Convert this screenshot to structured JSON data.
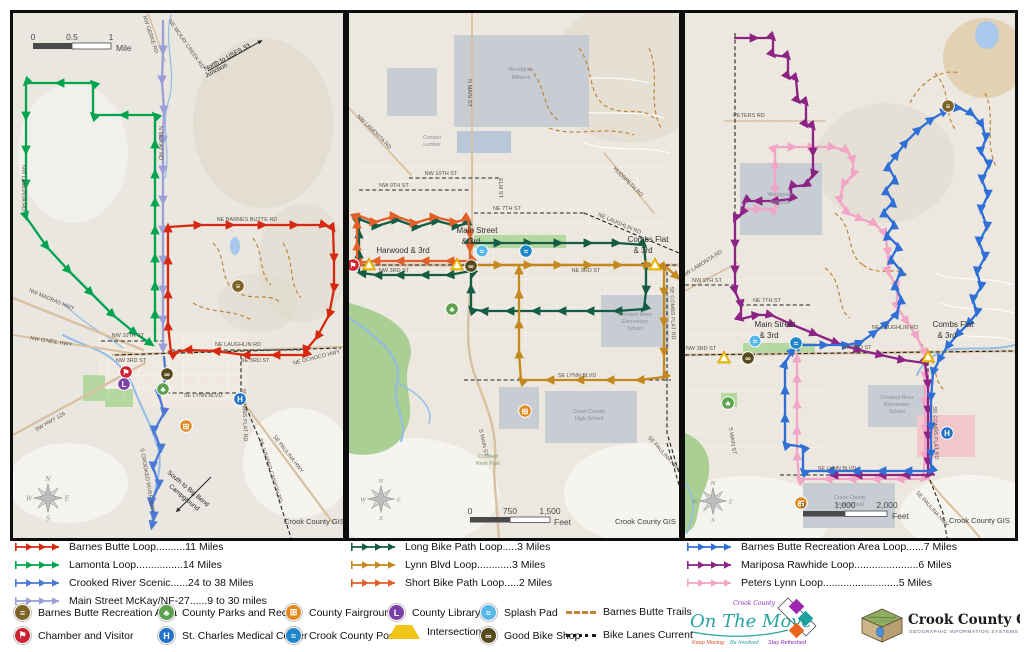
{
  "legend": {
    "left_routes": [
      {
        "label": "Barnes Butte Loop..........11 Miles",
        "color": "#d62910"
      },
      {
        "label": "Lamonta Loop................14 Miles",
        "color": "#00a44f"
      },
      {
        "label": "Crooked River Scenic......24 to 38 Miles",
        "color": "#4b79d4"
      },
      {
        "label": "Main Street McKay/NF-27......9 to 30 miles",
        "color": "#9c9ed8"
      }
    ],
    "mid_routes": [
      {
        "label": "Long Bike Path Loop.....3 Miles",
        "color": "#155c44"
      },
      {
        "label": "Lynn Blvd Loop............3 Miles",
        "color": "#c4881c"
      },
      {
        "label": "Short Bike Path Loop.....2 Miles",
        "color": "#e45f28"
      }
    ],
    "right_routes": [
      {
        "label": "Barnes Butte Recreation Area Loop......7 Miles",
        "color": "#2f6fd6"
      },
      {
        "label": "Mariposa Rawhide Loop......................6 Miles",
        "color": "#8c2385"
      },
      {
        "label": "Peters Lynn Loop..........................5 Miles",
        "color": "#f2a5c6"
      }
    ],
    "poi": {
      "butte": {
        "label": "Barnes Butte Recreation Area",
        "glyph": "≡",
        "color": "#7d6327"
      },
      "parks": {
        "label": "County Parks and Rec",
        "glyph": "♣",
        "color": "#5ba04b"
      },
      "fairgrounds": {
        "label": "County Fairgrounds",
        "glyph": "⊞",
        "color": "#e2891d"
      },
      "library": {
        "label": "County Library",
        "glyph": "L",
        "color": "#7b3fa8"
      },
      "splash": {
        "label": "Splash Pad",
        "glyph": "≈",
        "color": "#56b8e8"
      },
      "chamber": {
        "label": "Chamber and Visitor",
        "glyph": "⚑",
        "color": "#cf2030"
      },
      "hospital": {
        "label": "St. Charles Medical Center",
        "glyph": "H",
        "color": "#2272c8"
      },
      "pool": {
        "label": "Crook County Pool",
        "glyph": "≈",
        "color": "#1f86c9"
      },
      "intersections": {
        "label": "Intersections",
        "glyph": "",
        "color": "#f2c319"
      },
      "bikeshop": {
        "label": "Good Bike Shop",
        "glyph": "∞",
        "color": "#564a1a"
      }
    },
    "line_types": [
      {
        "label": "Barnes Butte Trails",
        "style": "dashed",
        "color": "#c08438"
      },
      {
        "label": "Bike Lanes Current",
        "style": "dotted",
        "color": "#1a1a1a"
      }
    ]
  },
  "compass": {
    "n": "N",
    "e": "E",
    "s": "S",
    "w": "W"
  },
  "maps": [
    {
      "scale": {
        "t0": "0",
        "t1": "0.5",
        "t2": "1",
        "unit": "Mile"
      },
      "attribution": "Crook County GIS",
      "annotations": {
        "north1": "North to USFS 33",
        "north2": "Junction",
        "south1": "South to Big Bend",
        "south2": "Campground"
      },
      "roads": {
        "gerke": "NW GERKE RD",
        "mckaycreek": "NE MCKAY CREEK RD",
        "mckay": "N MCKAY RD",
        "lamonta": "NW LAMONTA RD",
        "barnesbutte": "NE BARNES BUTTE RD",
        "madras": "NW MADRAS HWY",
        "oneil": "NW O'NEIL HWY",
        "hwy126": "SW HWY 126",
        "st10": "NW 10TH ST",
        "laughlin": "NE LAUGHLIN RD",
        "st3w": "NW 3RD ST",
        "st3e": "NE 3RD ST",
        "ochoco": "NE OCHOCO HWY",
        "lynn": "SE LYNN BLVD",
        "combs": "SE COMBS FLAT RD",
        "paulina": "SE PAULINA HWY",
        "juniper": "SE JUNIPER CANYON RD",
        "crookedriver": "S CROOKED RIVER HWY"
      }
    },
    {
      "scale": {
        "t0": "0",
        "t1": "750",
        "t2": "1,500",
        "unit": "Feet"
      },
      "attribution": "Crook County GIS",
      "junctions": {
        "harwood": "Harwood & 3rd",
        "main1": "Main Street",
        "main2": "& 3rd",
        "combs1": "Combs Flat",
        "combs2": "& 3rd"
      },
      "roads": {
        "lamonta": "NW LAMONTA RD",
        "main_n": "N MAIN ST",
        "st10": "NW 10TH ST",
        "st9": "NW 9TH ST",
        "st7": "NE 7TH ST",
        "laughlin": "NE LAUGHLIN RD",
        "hudspeth": "HUDSPETH RD",
        "elm": "ELM ST",
        "st3w": "NW 3RD ST",
        "st3e": "NE 3RD ST",
        "lynn": "SE LYNN BLVD",
        "main_s": "S MAIN ST",
        "combs": "SE COMBS FLAT RD",
        "paulina": "SE PAULINA HWY"
      },
      "places": {
        "wg1": "Woodgrain",
        "wg2": "Millwork",
        "cl1": "Contact",
        "cl2": "Lumber",
        "el1": "Crooked River",
        "el2": "Elementary",
        "el3": "School",
        "hs1": "Crook County",
        "hs2": "High School",
        "pk1": "Crooked",
        "pk2": "River Park"
      }
    },
    {
      "scale": {
        "t0": "0",
        "t1": "1,000",
        "t2": "2,000",
        "unit": "Feet"
      },
      "attribution": "Crook County GIS",
      "junctions": {
        "main1": "Main Street",
        "main2": "& 3rd",
        "combs1": "Combs Flat",
        "combs2": "& 3rd"
      },
      "roads": {
        "peters": "PETERS RD",
        "lamonta": "NW LAMONTA RD",
        "st9": "NW 9TH ST",
        "st7": "NE 7TH ST",
        "laughlin": "NE LAUGHLIN RD",
        "st3w": "NW 3RD ST",
        "st3e": "NE 3RD ST",
        "lynn": "SE LYNN BLVD",
        "main_s": "S MAIN ST",
        "combs": "SE COMBS FLAT RD",
        "paulina": "SE PAULINA HWY"
      },
      "places": {
        "wg1": "Woodgrain",
        "wg2": "Millwork",
        "el1": "Crooked River",
        "el2": "Elementary",
        "el3": "School",
        "hs1": "Crook County",
        "hs2": "High School"
      }
    }
  ],
  "logos": {
    "on_the_move": {
      "prefix": "Crook County",
      "title": "On The Move",
      "tag1": "Keep Moving",
      "tag2": "Be Involved",
      "tag3": "Stay Refreshed",
      "colors": [
        "#9b27af",
        "#1f9e9e",
        "#e8641f"
      ]
    },
    "gis": {
      "title": "Crook County GIS",
      "subtitle": "GEOGRAPHIC INFORMATION SYSTEMS"
    }
  }
}
